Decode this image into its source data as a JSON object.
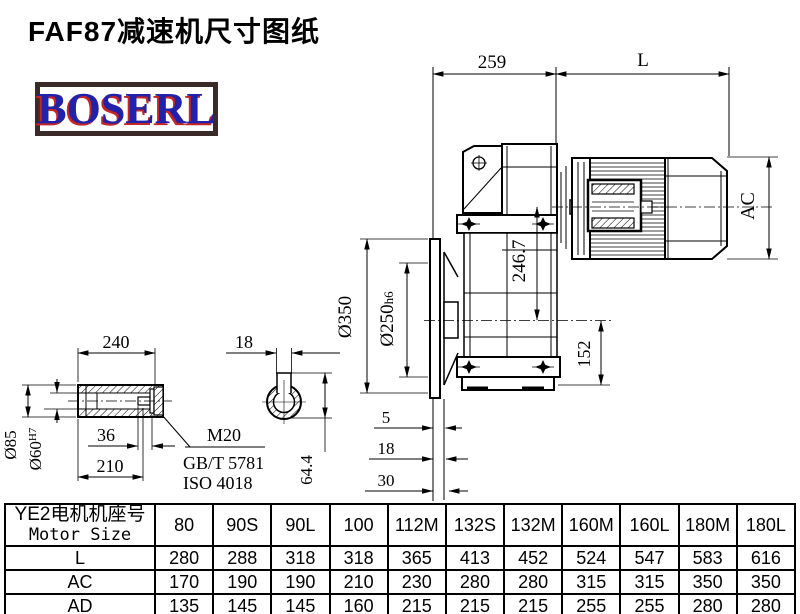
{
  "title": "FAF87减速机尺寸图纸",
  "logo": {
    "text": "BOSERL",
    "text_color": "#2121aa",
    "shadow_color": "#c42525",
    "border_color": "#3a2a28"
  },
  "drawing": {
    "dims": {
      "top_width": "259",
      "motor_len": "L",
      "motor_dia": "AC",
      "center_height": "246.7",
      "flange_od": "Ø350",
      "spigot": "Ø250",
      "spigot_tol": "h6",
      "base_height": "152",
      "shaft_len": "240",
      "key_width": "18",
      "shaft_od": "Ø85",
      "bore": "Ø60",
      "bore_tol": "H7",
      "thread_len": "36",
      "shaft_step": "210",
      "key_depth": "64.4",
      "flange_t1": "5",
      "flange_t2": "18",
      "flange_t3": "30",
      "bolt": "M20",
      "bolt_std_gb": "GB/T 5781",
      "bolt_std_iso": "ISO 4018"
    }
  },
  "table": {
    "header_cn": "YE2电机机座号",
    "header_en": "Motor Size",
    "columns": [
      "80",
      "90S",
      "90L",
      "100",
      "112M",
      "132S",
      "132M",
      "160M",
      "160L",
      "180M",
      "180L"
    ],
    "rows": [
      {
        "label": "L",
        "values": [
          "280",
          "288",
          "318",
          "318",
          "365",
          "413",
          "452",
          "524",
          "547",
          "583",
          "616"
        ]
      },
      {
        "label": "AC",
        "values": [
          "170",
          "190",
          "190",
          "210",
          "230",
          "280",
          "280",
          "315",
          "315",
          "350",
          "350"
        ]
      },
      {
        "label": "AD",
        "values": [
          "135",
          "145",
          "145",
          "160",
          "215",
          "215",
          "215",
          "255",
          "255",
          "280",
          "280"
        ]
      }
    ]
  }
}
